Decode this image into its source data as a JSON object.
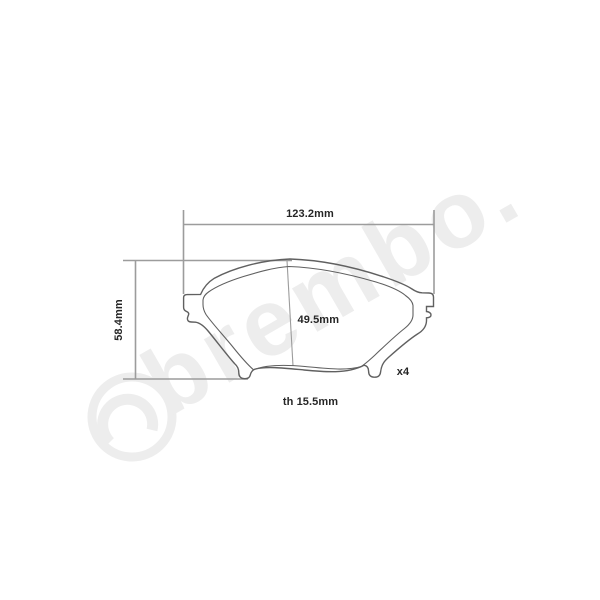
{
  "watermark": {
    "text": "brembo.",
    "color": "#ededed",
    "logo_icon": "brembo-disc-logo"
  },
  "drawing": {
    "labels": {
      "overall_width": "123.2mm",
      "overall_height": "58.4mm",
      "pad_height": "49.5mm",
      "quantity": "x4",
      "thickness": "th 15.5mm"
    },
    "colors": {
      "background": "#ffffff",
      "outline": "#606060",
      "dimension_line": "#9c9c9c",
      "label_text": "#262626"
    }
  }
}
